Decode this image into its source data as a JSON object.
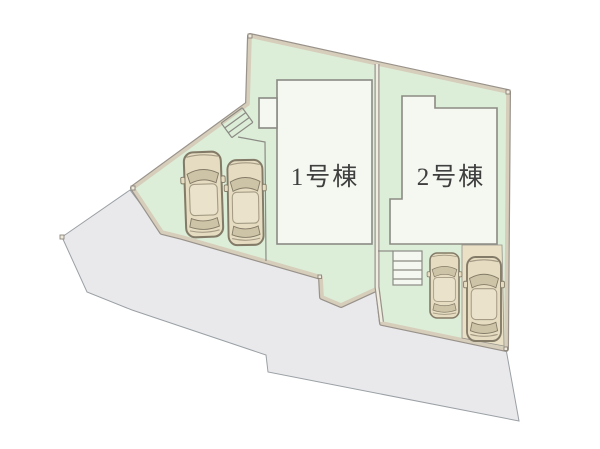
{
  "site_plan": {
    "type": "residential-lot-layout",
    "buildings": [
      {
        "id": "building-1",
        "label": "1号棟",
        "parked_cars": 2
      },
      {
        "id": "building-2",
        "label": "2号棟",
        "parked_cars": 2
      }
    ],
    "features": {
      "road": "road area (gray)",
      "lot": "site grounds (light green)",
      "stairs_count": 2,
      "parking_pad": "paved parking pad (beige)"
    },
    "colors": {
      "lot-green": "#dcedd8",
      "boundary-tan": "#d6cdba",
      "boundary-gray": "#98928a",
      "divider-light": "#efece0",
      "building-fill": "#f4f8f0",
      "line-gray": "#8b8b84",
      "road-fill": "#e9e9ec",
      "road-stroke": "#9aa0a4",
      "pad-fill": "#e9e0c6",
      "car-body": "#e5dcc1",
      "car-outline": "#837b67",
      "car-glass": "#cdc3a6",
      "car-roof": "#eae2ca",
      "car-line": "#a59b85",
      "label-color": "#3f3f3f"
    }
  }
}
